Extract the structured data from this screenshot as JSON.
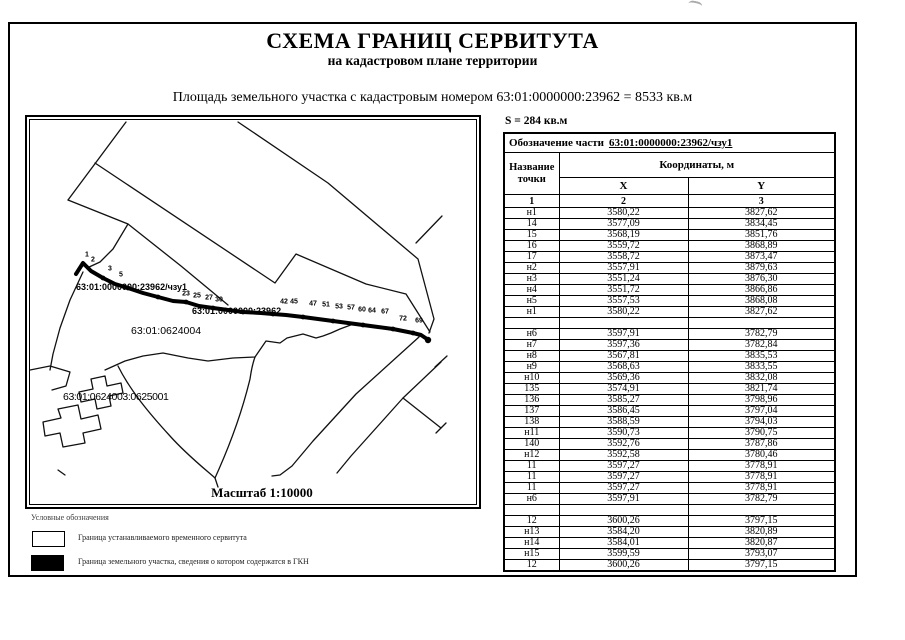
{
  "doc": {
    "title": "СХЕМА ГРАНИЦ СЕРВИТУТА",
    "subtitle": "на кадастровом плане территории",
    "area_line": "Площадь земельного участка с кадастровым номером 63:01:0000000:23962 = 8533 кв.м"
  },
  "map": {
    "scale_label": "Масштаб 1:10000",
    "labels": {
      "servitude_part": "63:01:0000000:23962/чзу1",
      "parcel_under_line": "63:01:0000000:23962",
      "quarter_1": "63:01:0624004",
      "quarter_2": "63:01:0624003:0625001"
    },
    "point_labels": [
      {
        "t": "1",
        "x": 60,
        "y": 138
      },
      {
        "t": "2",
        "x": 66,
        "y": 143
      },
      {
        "t": "3",
        "x": 83,
        "y": 152
      },
      {
        "t": "5",
        "x": 94,
        "y": 158
      },
      {
        "t": "23",
        "x": 159,
        "y": 177
      },
      {
        "t": "25",
        "x": 170,
        "y": 179
      },
      {
        "t": "27",
        "x": 182,
        "y": 181
      },
      {
        "t": "30",
        "x": 192,
        "y": 183
      },
      {
        "t": "42",
        "x": 257,
        "y": 185
      },
      {
        "t": "45",
        "x": 267,
        "y": 185
      },
      {
        "t": "47",
        "x": 286,
        "y": 187
      },
      {
        "t": "51",
        "x": 299,
        "y": 188
      },
      {
        "t": "53",
        "x": 312,
        "y": 190
      },
      {
        "t": "57",
        "x": 324,
        "y": 191
      },
      {
        "t": "60",
        "x": 335,
        "y": 193
      },
      {
        "t": "64",
        "x": 345,
        "y": 194
      },
      {
        "t": "67",
        "x": 358,
        "y": 195
      },
      {
        "t": "72",
        "x": 376,
        "y": 202
      },
      {
        "t": "69",
        "x": 392,
        "y": 204
      }
    ]
  },
  "table": {
    "area_label": "S = 284 кв.м",
    "part_label_prefix": "Обозначение части",
    "part_value": "63:01:0000000:23962/чзу1",
    "col_point": "Название точки",
    "col_coords": "Координаты, м",
    "col_x": "X",
    "col_y": "Y",
    "col_nums": [
      "1",
      "2",
      "3"
    ],
    "rows": [
      [
        "н1",
        "3580,22",
        "3827,62"
      ],
      [
        "14",
        "3577,09",
        "3834,45"
      ],
      [
        "15",
        "3568,19",
        "3851,76"
      ],
      [
        "16",
        "3559,72",
        "3868,89"
      ],
      [
        "17",
        "3558,72",
        "3873,47"
      ],
      [
        "н2",
        "3557,91",
        "3879,63"
      ],
      [
        "н3",
        "3551,24",
        "3876,30"
      ],
      [
        "н4",
        "3551,72",
        "3866,86"
      ],
      [
        "н5",
        "3557,53",
        "3868,08"
      ],
      [
        "н1",
        "3580,22",
        "3827,62"
      ],
      [
        "",
        "",
        ""
      ],
      [
        "н6",
        "3597,91",
        "3782,79"
      ],
      [
        "н7",
        "3597,36",
        "3782,84"
      ],
      [
        "н8",
        "3567,81",
        "3835,53"
      ],
      [
        "н9",
        "3568,63",
        "3833,55"
      ],
      [
        "н10",
        "3569,36",
        "3832,08"
      ],
      [
        "135",
        "3574,91",
        "3821,74"
      ],
      [
        "136",
        "3585,27",
        "3798,96"
      ],
      [
        "137",
        "3586,45",
        "3797,04"
      ],
      [
        "138",
        "3588,59",
        "3794,03"
      ],
      [
        "н11",
        "3590,73",
        "3790,75"
      ],
      [
        "140",
        "3592,76",
        "3787,86"
      ],
      [
        "н12",
        "3592,58",
        "3780,46"
      ],
      [
        "11",
        "3597,27",
        "3778,91"
      ],
      [
        "11",
        "3597,27",
        "3778,91"
      ],
      [
        "11",
        "3597,27",
        "3778,91"
      ],
      [
        "н6",
        "3597,91",
        "3782,79"
      ],
      [
        "",
        "",
        ""
      ],
      [
        "12",
        "3600,26",
        "3797,15"
      ],
      [
        "н13",
        "3584,20",
        "3820,89"
      ],
      [
        "н14",
        "3584,01",
        "3820,87"
      ],
      [
        "н15",
        "3599,59",
        "3793,07"
      ],
      [
        "12",
        "3600,26",
        "3797,15"
      ]
    ]
  },
  "legend": {
    "title": "Условные обозначения",
    "items": [
      {
        "label": "Граница устанавливаемого временного сервитута"
      },
      {
        "label": "Граница земельного участка, сведения о котором содержатся в ГКН"
      }
    ]
  },
  "colors": {
    "ink": "#000000",
    "faded": "#3c3c3c"
  }
}
